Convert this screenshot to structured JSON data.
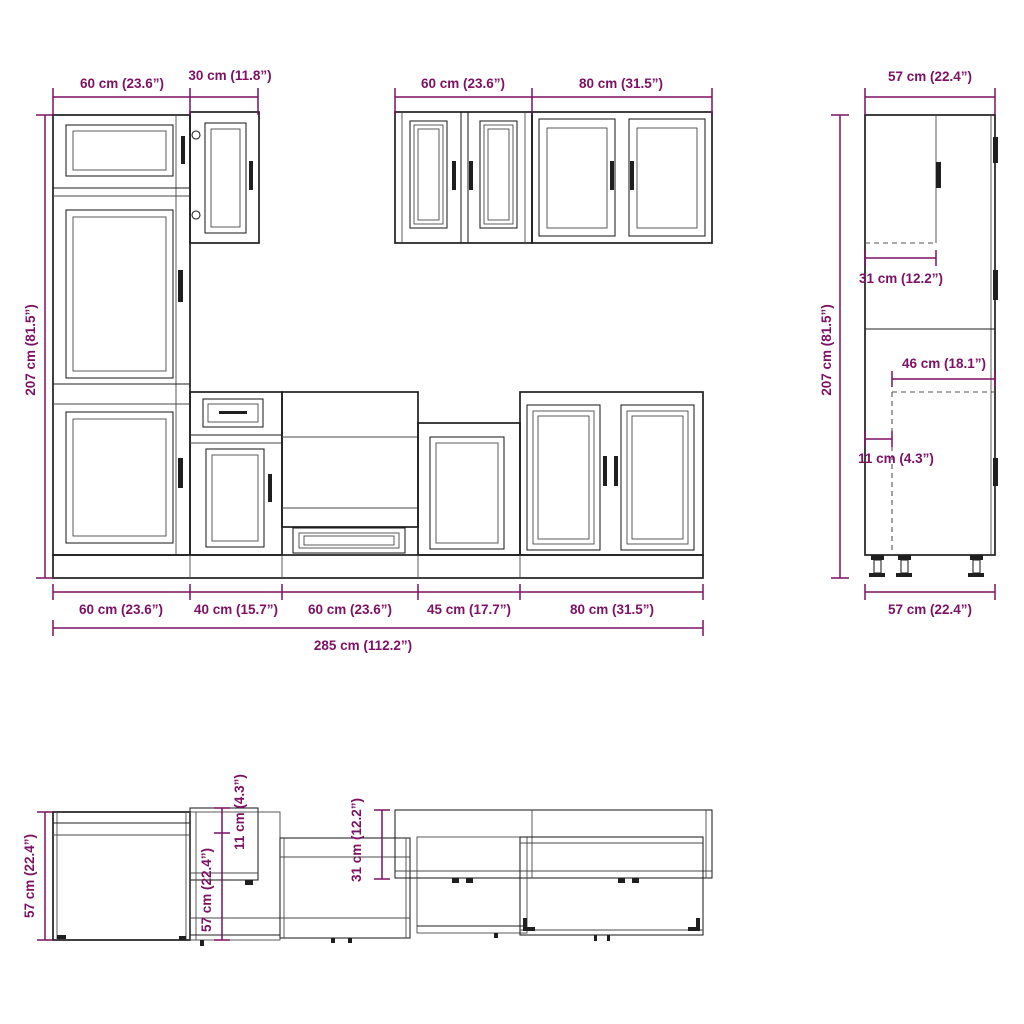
{
  "colors": {
    "dimension": "#7d1164",
    "outline": "#1f1f1f"
  },
  "front_elevation": {
    "tall_unit_width": "60 cm (23.6”)",
    "upper_cabinet_width": "30 cm (11.8”)",
    "wall_cabinet_width_left": "60 cm (23.6”)",
    "wall_cabinet_width_right": "80 cm (31.5”)",
    "height": "207 cm (81.5”)",
    "base_widths": [
      "60 cm (23.6”)",
      "40 cm (15.7”)",
      "60 cm (23.6”)",
      "45 cm (17.7”)",
      "80 cm (31.5”)"
    ],
    "total_width": "285 cm (112.2”)"
  },
  "side_view": {
    "depth_top": "57 cm (22.4”)",
    "height": "207 cm (81.5”)",
    "wall_cabinet_depth": "31 cm (12.2”)",
    "carcass_depth": "46 cm (18.1”)",
    "wall_offset": "11 cm (4.3”)",
    "depth_bottom": "57 cm (22.4”)"
  },
  "plan_view": {
    "base_depth": "57 cm (22.4”)",
    "cabinet_depth": "57 cm (22.4”)",
    "front_offset": "11 cm (4.3”)",
    "wall_cabinet_depth": "31 cm (12.2”)"
  }
}
